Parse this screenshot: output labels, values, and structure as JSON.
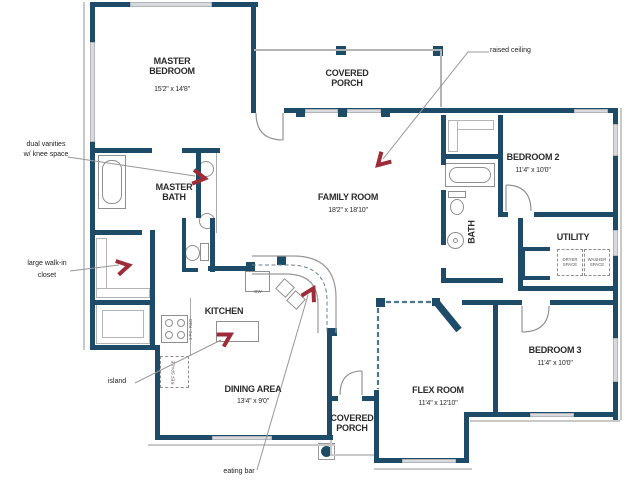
{
  "title": "house floor plan",
  "colors": {
    "wall": "#1e4c68",
    "arrow": "#9e2b38",
    "leader": "#979797",
    "window": "#d8dadd",
    "fixture": "#8f8f8f",
    "roof": "#c9c9c9",
    "text": "#2b2b2b"
  },
  "rooms": {
    "master_bedroom": {
      "name": "MASTER BEDROOM",
      "dims": "15'2\" x 14'8\""
    },
    "covered_porch_top": {
      "name": "COVERED PORCH"
    },
    "family_room": {
      "name": "FAMILY ROOM",
      "dims": "18'2\" x 18'10\""
    },
    "bedroom2": {
      "name": "BEDROOM 2",
      "dims": "11'4\" x 10'0\""
    },
    "master_bath": {
      "name": "MASTER BATH"
    },
    "bath": {
      "name": "BATH"
    },
    "utility": {
      "name": "UTILITY"
    },
    "kitchen": {
      "name": "KITCHEN"
    },
    "dining": {
      "name": "DINING AREA",
      "dims": "13'4\" x 9'0\""
    },
    "flex": {
      "name": "FLEX ROOM",
      "dims": "11'4\" x 12'10\""
    },
    "bedroom3": {
      "name": "BEDROOM 3",
      "dims": "11'4\" x 10'0\""
    },
    "covered_porch_bottom": {
      "name": "COVERED PORCH"
    }
  },
  "annotations": {
    "raised_ceiling": "raised ceiling",
    "dual_vanities_line1": "dual vanities",
    "dual_vanities_line2": "w/ knee space",
    "walk_in_line1": "large walk-in",
    "walk_in_line2": "closet",
    "island": "island",
    "eating_bar": "eating bar"
  },
  "fixtures": {
    "dryer": "DRYER SPACE",
    "washer": "WASHER SPACE",
    "ref": "REF SPACE",
    "range": "1 PC. R&O",
    "dishwasher": "DW"
  }
}
